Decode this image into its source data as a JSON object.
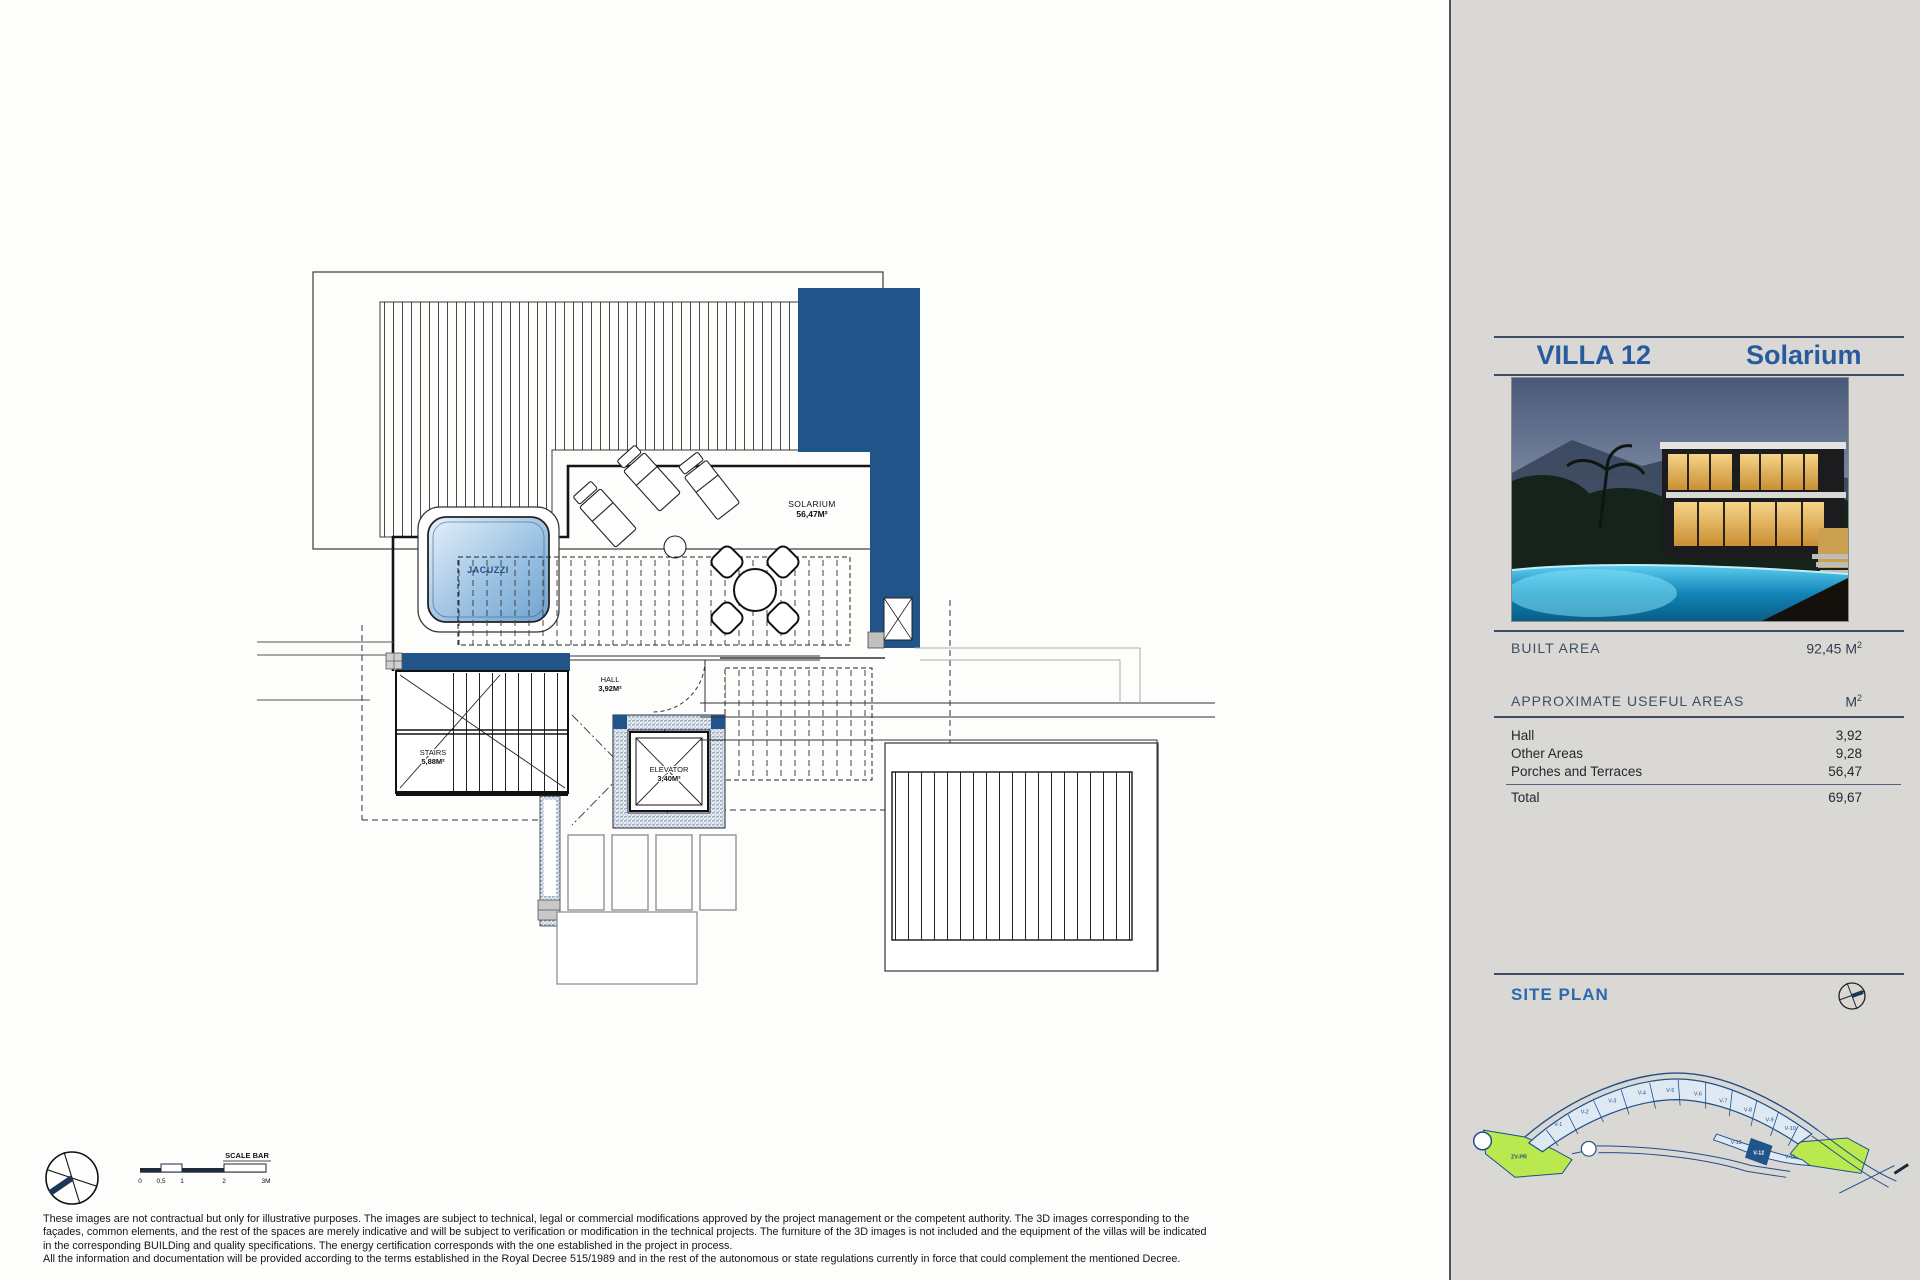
{
  "panel": {
    "title": "VILLA 12",
    "subtitle": "Solarium",
    "built_area": {
      "label": "BUILT AREA",
      "value": "92,45 M",
      "sup": "2"
    },
    "useful_areas": {
      "label": "APPROXIMATE USEFUL AREAS",
      "unit": "M",
      "unit_sup": "2",
      "rows": [
        {
          "label": "Hall",
          "value": "3,92"
        },
        {
          "label": "Other Areas",
          "value": "9,28"
        },
        {
          "label": "Porches and Terraces",
          "value": "56,47"
        }
      ],
      "total": {
        "label": "Total",
        "value": "69,67"
      }
    },
    "site_plan": {
      "label": "SITE PLAN",
      "zone_label": "ZV-PR",
      "plots": [
        "V-1",
        "V-2",
        "V-3",
        "V-4",
        "V-5",
        "V-6",
        "V-7",
        "V-8",
        "V-9",
        "V-10",
        "V-13",
        "V-12",
        "V-11"
      ],
      "highlighted_plot": "V-12"
    }
  },
  "plan": {
    "labels": {
      "jacuzzi": "JACUZZI",
      "solarium": "SOLARIUM",
      "solarium_area": "56,47M²",
      "hall": "HALL",
      "hall_area": "3,92M²",
      "stairs": "STAIRS",
      "stairs_area": "5,88M²",
      "elevator": "ELEVATOR",
      "elevator_area": "3,40M²"
    },
    "scale_bar": {
      "label": "SCALE BAR",
      "ticks": [
        "0",
        "0,5",
        "1",
        "2",
        "3M"
      ]
    }
  },
  "disclaimer": {
    "lines": [
      "These images are not contractual but only for illustrative purposes. The images are subject to technical, legal or commercial modifications approved by the project management or the competent authority. The 3D images corresponding to the",
      "façades, common elements, and the rest of the spaces are merely indicative and will be subject to verification or modification in the technical projects. The furniture of the 3D images is not included and the equipment of the villas will be indicated",
      "in the corresponding BUILDing and quality specifications. The energy certification corresponds with the one established in the project in process.",
      "All the information and documentation will be provided according to the terms established in the Royal Decree 515/1989 and in the rest of the autonomous or state regulations currently in force that could complement the mentioned Decree."
    ]
  },
  "colors": {
    "accent_blue": "#215589",
    "title_blue": "#2a5a9e",
    "panel_bg": "#d9d8d4",
    "site_green": "#b9e94f",
    "site_line_blue": "#1d4f8a",
    "pool_cyan": "#5ecdf0"
  }
}
